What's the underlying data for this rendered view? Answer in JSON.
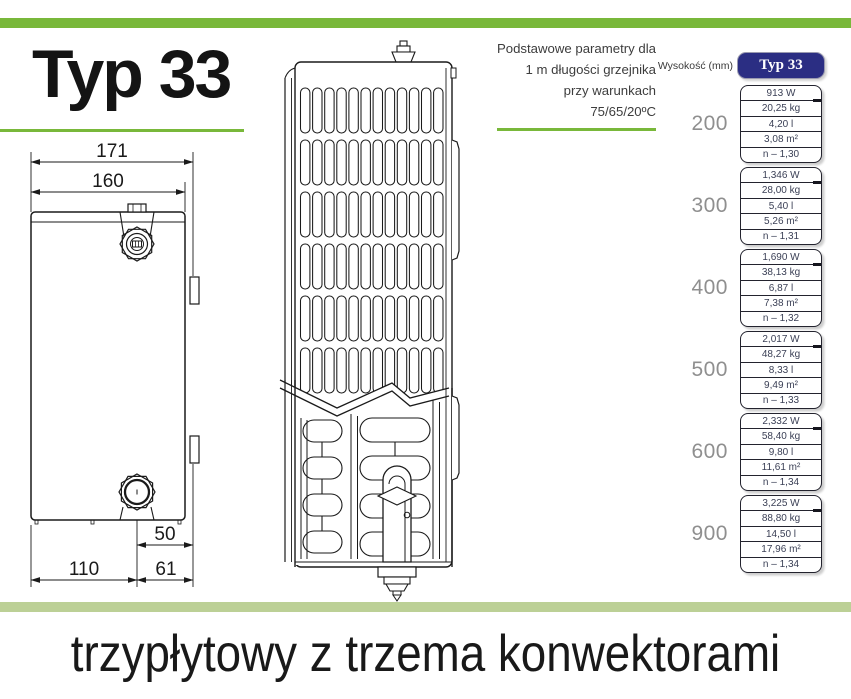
{
  "accent": {
    "green": "#79b83a",
    "sage": "#bcd096",
    "navy": "#2b2e83"
  },
  "title": "Typ 33",
  "params_note": {
    "line1": "Podstawowe parametry dla",
    "line2": "1 m długości grzejnika",
    "line3": "przy warunkach",
    "line4": "75/65/20ºC"
  },
  "diagram": {
    "side_view": {
      "dims": {
        "total_width": "171",
        "body_width": "160",
        "valve_offset": "50",
        "left_offset": "110",
        "right_offset": "61"
      }
    }
  },
  "table": {
    "col_header": "Wysokość (mm)",
    "type_header": "Typ 33",
    "groups": [
      {
        "height": "200",
        "rows": [
          "913 W",
          "20,25 kg",
          "4,20 l",
          "3,08 m²",
          "n – 1,30"
        ]
      },
      {
        "height": "300",
        "rows": [
          "1,346 W",
          "28,00 kg",
          "5,40 l",
          "5,26 m²",
          "n – 1,31"
        ]
      },
      {
        "height": "400",
        "rows": [
          "1,690 W",
          "38,13 kg",
          "6,87 l",
          "7,38 m²",
          "n – 1,32"
        ]
      },
      {
        "height": "500",
        "rows": [
          "2,017 W",
          "48,27 kg",
          "8,33 l",
          "9,49 m²",
          "n – 1,33"
        ]
      },
      {
        "height": "600",
        "rows": [
          "2,332 W",
          "58,40 kg",
          "9,80 l",
          "11,61 m²",
          "n – 1,34"
        ]
      },
      {
        "height": "900",
        "rows": [
          "3,225 W",
          "88,80 kg",
          "14,50 l",
          "17,96 m²",
          "n – 1,34"
        ]
      }
    ]
  },
  "footer": {
    "headline": "trzypłytowy z trzema konwektorami"
  }
}
